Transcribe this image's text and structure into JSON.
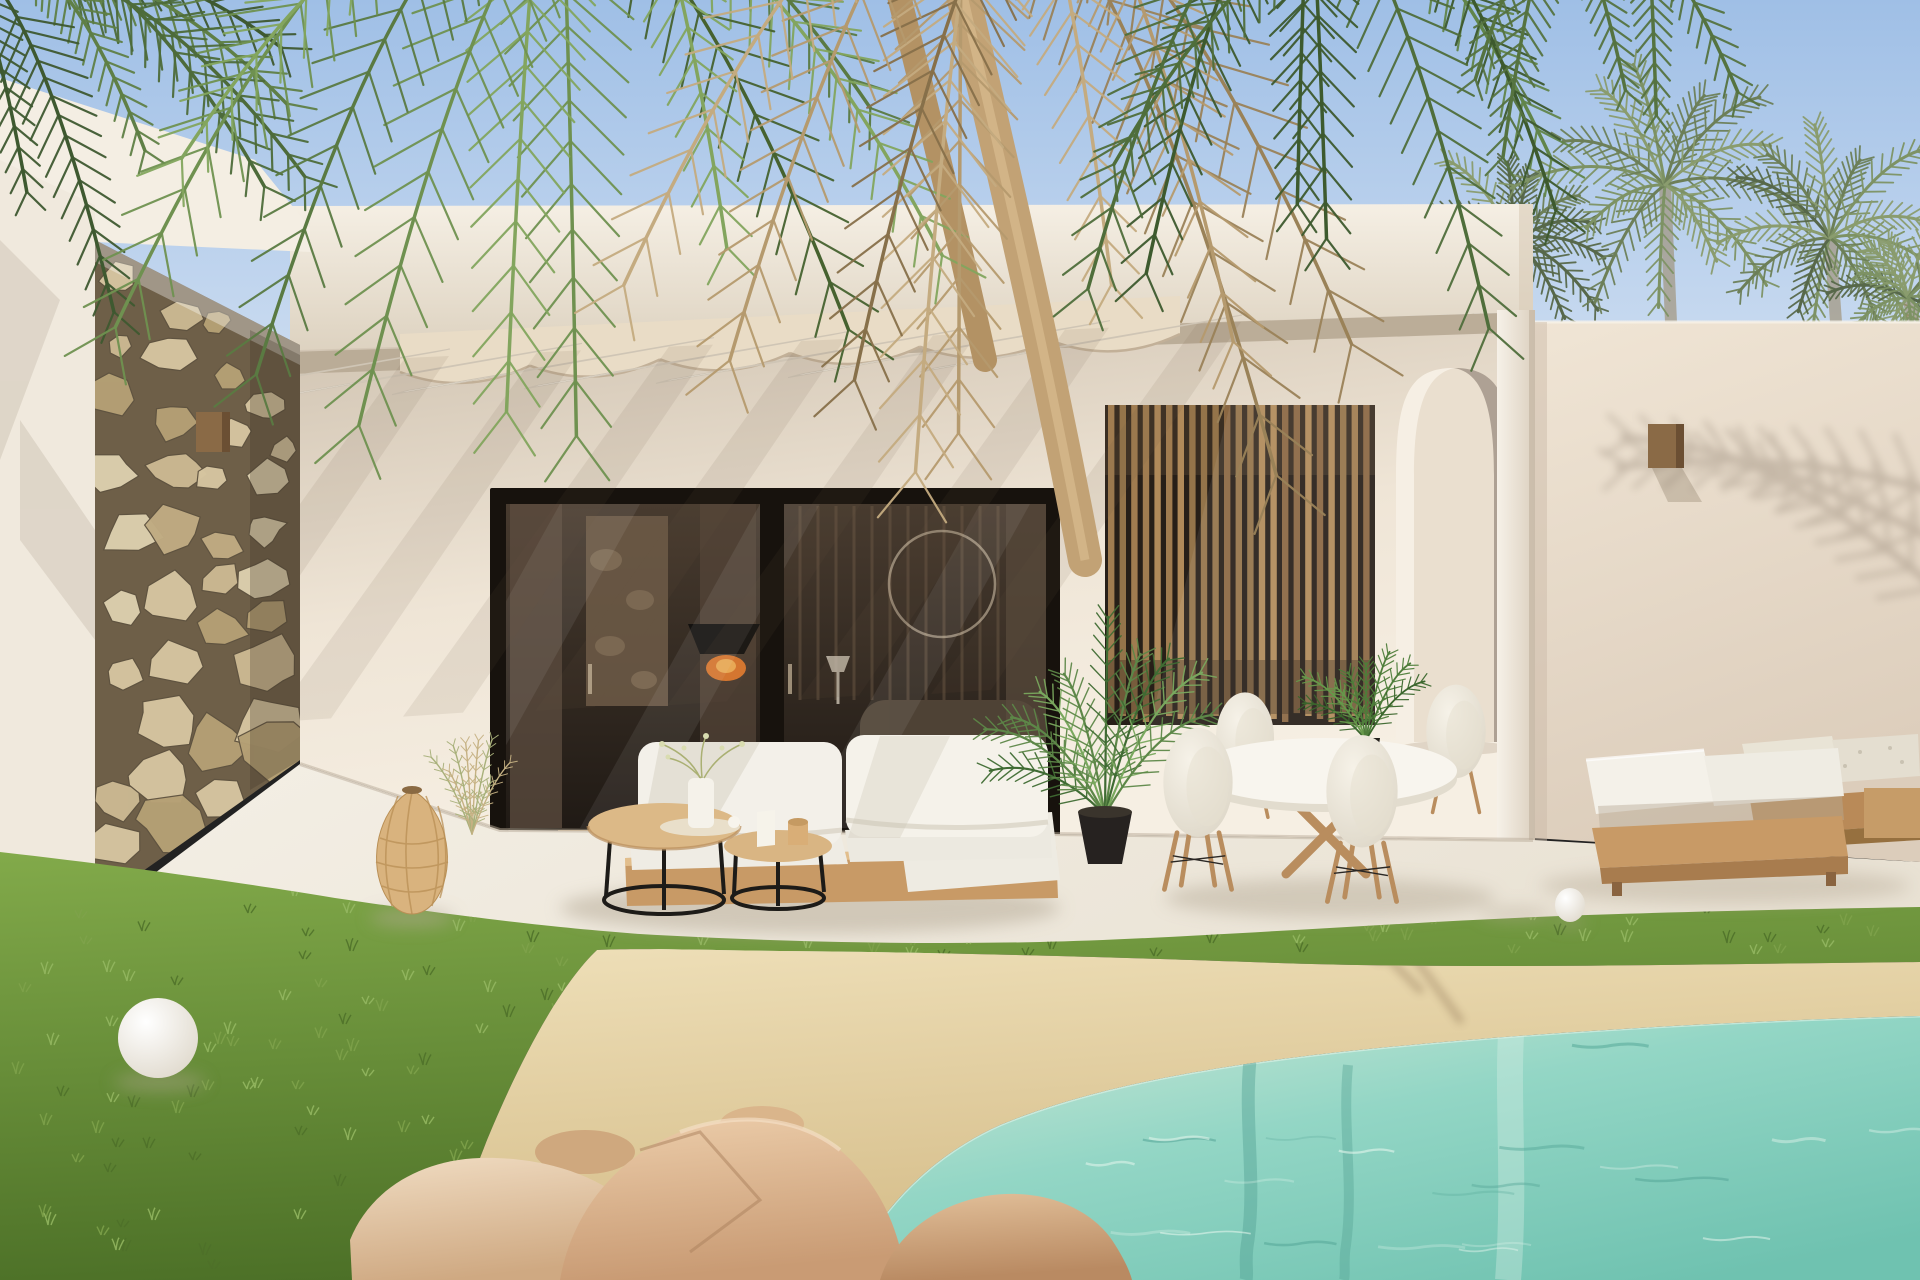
{
  "scene": {
    "description": "Photorealistic exterior render of a modern white Mediterranean villa with stone accent wall, pergola-shaded patio, black-framed sliding glass doors, wood slat screen, arched doorway, outdoor lounge and dining furniture, lawn, and a beach-entry turquoise pool framed by boulders and overhanging palm fronds",
    "type": "exterior-architectural-render",
    "palette": {
      "sky_top": "#9fbfe6",
      "sky_bottom": "#d6e3f3",
      "fascia_light": "#f5efe4",
      "fascia_shadow": "#ddd2c0",
      "wall_right_light": "#f0e5d5",
      "wall_right_shadow": "#dccdbb",
      "facade_light": "#efe5d6",
      "facade_shadow": "#cfc2b0",
      "parapet": "#f4eee3",
      "left_wall": "#f0e9dd",
      "frame_dark": "#17120d",
      "glass_top": "#483b2f",
      "glass_bottom": "#201a15",
      "slat_bg": "#271f18",
      "floor_light": "#f4efe5",
      "floor_warm": "#e9e2d4",
      "grass_light": "#82aa4a",
      "grass_dark": "#4c7027",
      "sand_light": "#eedfb8",
      "sand_dark": "#d3ba85",
      "water_shallow": "#cfe9d8",
      "water_mid": "#93d6c5",
      "water_deep": "#6fc2b0",
      "cushion_white": "#f3f0e8",
      "teak": "#c89a66",
      "teak_dark": "#a87c4e",
      "wood_top": "#d9b583",
      "metal_black": "#1d1b18",
      "arch_inner": "#eadfcf",
      "arch_shadow": "#a3978a",
      "column_light": "#f6f1e8",
      "column_shade": "#dcd0bf",
      "rattan": "#d9b37e",
      "rattan_dark": "#b98f55"
    },
    "decor": {
      "seed": 11,
      "stones": {
        "count": 46,
        "colors": [
          "#d6c5a0",
          "#cbb892",
          "#c0ab82",
          "#dccfae",
          "#b5a075"
        ],
        "gap_color": "#6e5f48"
      },
      "slats": {
        "count": 23,
        "colors": [
          "#a07c50",
          "#8a6742",
          "#b08a5a",
          "#94744a"
        ]
      },
      "beams": {
        "count": 7,
        "color": "#f7f2e8",
        "shadow_color": "#6b5a44"
      },
      "scallops": {
        "count": 6,
        "color": "#e9dcc6",
        "edge_color": "#c2b098"
      },
      "grass_tufts": {
        "count": 170,
        "colors": [
          "#7fa24b",
          "#4e7029",
          "#95b863"
        ]
      },
      "ripples": {
        "count": 26,
        "light": "#e9f7ef",
        "dark": "#57a899"
      },
      "palm_shadow_color": "#6e5f50",
      "crowns": [
        {
          "x": 1515,
          "y": 242,
          "r": 92
        },
        {
          "x": 1665,
          "y": 185,
          "r": 124
        },
        {
          "x": 1830,
          "y": 238,
          "r": 108
        },
        {
          "x": 1908,
          "y": 298,
          "r": 80
        }
      ],
      "crown_colors": [
        "#6d7f58",
        "#7d9264",
        "#57684a",
        "#8a9c6e"
      ],
      "clusters": [
        {
          "x": -30,
          "y": -40,
          "count": 7,
          "a0": 18,
          "a1": 78,
          "l0": 230,
          "l1": 360,
          "colors": [
            "#4d6b3a",
            "#5f7f46",
            "#3e5930"
          ]
        },
        {
          "x": 560,
          "y": -160,
          "count": 10,
          "a0": 40,
          "a1": 140,
          "l0": 430,
          "l1": 640,
          "colors": [
            "#5a7a42",
            "#6f9150",
            "#83a55e",
            "#46622f"
          ]
        },
        {
          "x": 1000,
          "y": -180,
          "count": 9,
          "a0": 55,
          "a1": 125,
          "l0": 480,
          "l1": 700,
          "colors": [
            "#b59a6e",
            "#c4ab80",
            "#9a8258",
            "#87704a"
          ]
        },
        {
          "x": 1330,
          "y": -140,
          "count": 8,
          "a0": 50,
          "a1": 130,
          "l0": 320,
          "l1": 520,
          "colors": [
            "#4f6e3b",
            "#61854a",
            "#3d5a2e"
          ]
        },
        {
          "x": 1600,
          "y": -90,
          "count": 5,
          "a0": 55,
          "a1": 115,
          "l0": 170,
          "l1": 280,
          "colors": [
            "#557340",
            "#6b8a50"
          ]
        }
      ]
    },
    "objects": [
      {
        "name": "villa",
        "label": "modern white villa with flat roof"
      },
      {
        "name": "stone-wall",
        "label": "natural stone accent wall"
      },
      {
        "name": "glass-doors",
        "label": "black framed sliding glass doors"
      },
      {
        "name": "slat-screen",
        "label": "vertical wood slat privacy screen"
      },
      {
        "name": "arched-doorway",
        "label": "tall arched doorway"
      },
      {
        "name": "outdoor-sofa",
        "label": "outdoor sofa with white cushions"
      },
      {
        "name": "coffee-tables",
        "label": "nesting coffee tables with wood tops"
      },
      {
        "name": "rattan-lantern",
        "label": "woven rattan floor lantern"
      },
      {
        "name": "dining-set",
        "label": "round dining table with four white chairs"
      },
      {
        "name": "sun-loungers",
        "label": "teak sun loungers with white cushions"
      },
      {
        "name": "lawn",
        "label": "green lawn"
      },
      {
        "name": "pool",
        "label": "beach-entry turquoise pool with sand edge"
      },
      {
        "name": "boulders",
        "label": "sandstone boulders"
      },
      {
        "name": "palms",
        "label": "overhanging palm fronds and palm canopy"
      }
    ]
  }
}
